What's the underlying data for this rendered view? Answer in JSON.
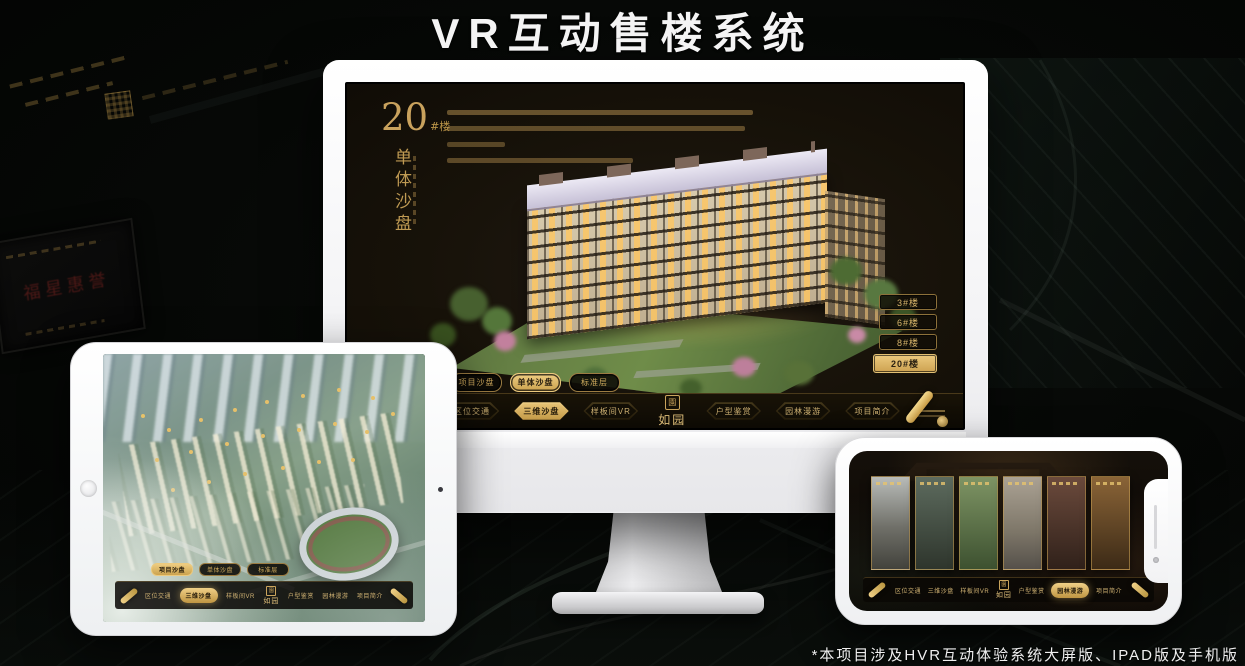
{
  "title": "VR互动售楼系统",
  "footnote": "*本项目涉及HVR互动体验系统大屏版、IPAD版及手机版",
  "colors": {
    "gold": "#d2ab5e",
    "gold_bright": "#ecca7e",
    "screen_bg": "#171209"
  },
  "nav_menu": {
    "logo": "如园",
    "seal_glyph": "園",
    "items": [
      "区位交通",
      "三维沙盘",
      "样板间VR",
      "户型鉴赏",
      "园林漫游",
      "项目简介"
    ]
  },
  "monitor_ui": {
    "block_number": "20",
    "block_suffix": "#楼",
    "block_subtitle": "单体沙盘",
    "floor_buttons": [
      "3#楼",
      "6#楼",
      "8#楼",
      "20#楼"
    ],
    "active_floor": "20#楼",
    "sub_tabs": [
      "项目沙盘",
      "单体沙盘",
      "标准层"
    ],
    "active_sub_tab": "单体沙盘",
    "active_nav_item": "三维沙盘"
  },
  "ipad_ui": {
    "sub_tabs": [
      "项目沙盘",
      "单体沙盘",
      "标准层"
    ],
    "active_sub_tab": "项目沙盘",
    "active_nav_item": "三维沙盘"
  },
  "phone_ui": {
    "active_nav_item": "园林漫游"
  },
  "background": {
    "plaque_text": "福星惠誉"
  }
}
